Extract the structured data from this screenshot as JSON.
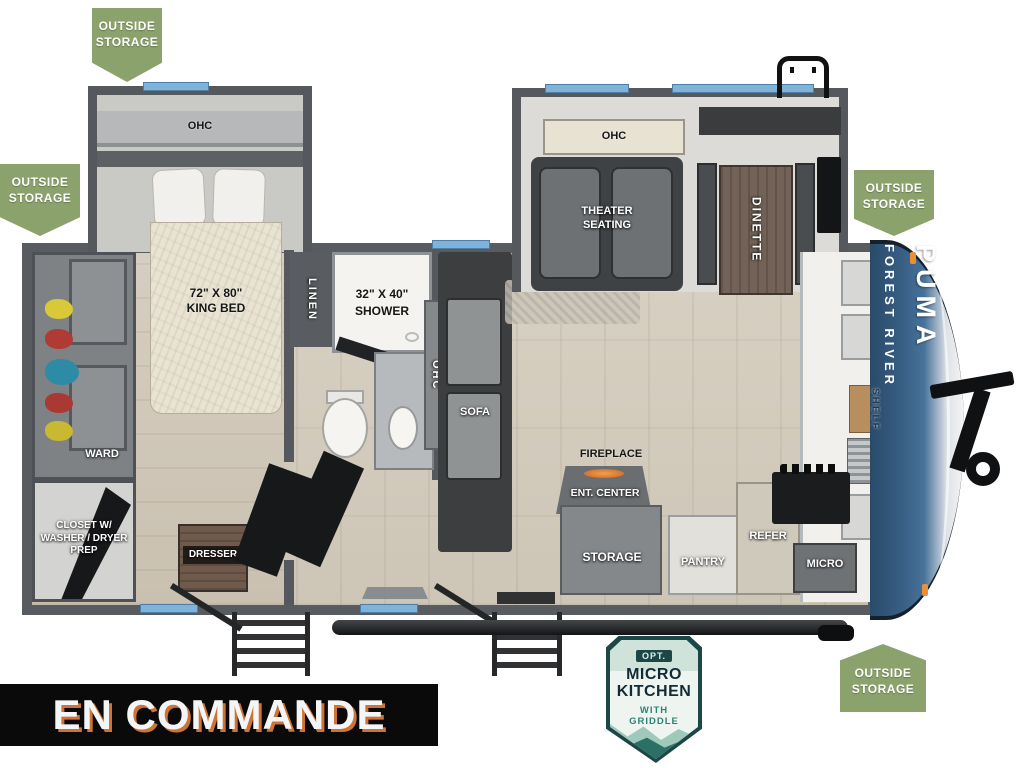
{
  "status_banner": {
    "text": "EN COMMANDE"
  },
  "storage_badges": [
    {
      "line1": "OUTSIDE",
      "line2": "STORAGE",
      "position": "top-left"
    },
    {
      "line1": "OUTSIDE",
      "line2": "STORAGE",
      "position": "rear-left"
    },
    {
      "line1": "OUTSIDE",
      "line2": "STORAGE",
      "position": "front-right"
    },
    {
      "line1": "OUTSIDE",
      "line2": "STORAGE",
      "position": "bottom-front"
    }
  ],
  "floorplan": {
    "bedroom": {
      "ohc": "OHC",
      "bed_size": "72\" X 80\"",
      "bed_type": "KING BED",
      "ward": "WARD",
      "closet_line1": "CLOSET W/",
      "closet_line2": "WASHER / DRYER",
      "closet_line3": "PREP",
      "dresser": "DRESSER"
    },
    "bathroom": {
      "linen": "LINEN",
      "shower_size": "32\" X 40\"",
      "shower_type": "SHOWER"
    },
    "living": {
      "ohc": "OHC",
      "sofa": "SOFA",
      "theater_ohc": "OHC",
      "theater_line1": "THEATER",
      "theater_line2": "SEATING",
      "dinette": "DINETTE",
      "fireplace": "FIREPLACE",
      "ent_center": "ENT. CENTER"
    },
    "kitchen": {
      "storage": "STORAGE",
      "pantry": "PANTRY",
      "refer": "REFER",
      "micro": "MICRO",
      "shelf": "SHELF"
    },
    "brand": {
      "manufacturer": "FOREST RIVER",
      "model": "PUMA"
    }
  },
  "option_badge": {
    "tag": "OPT.",
    "line1": "MICRO",
    "line2": "KITCHEN",
    "sub1": "WITH",
    "sub2": "GRIDDLE"
  },
  "colors": {
    "badge_green": "#8CA26C",
    "banner_orange": "#CD7334",
    "cap_blue": "#3A6188",
    "window_blue": "#7FB3D9",
    "option_teal": "#2F8274"
  }
}
